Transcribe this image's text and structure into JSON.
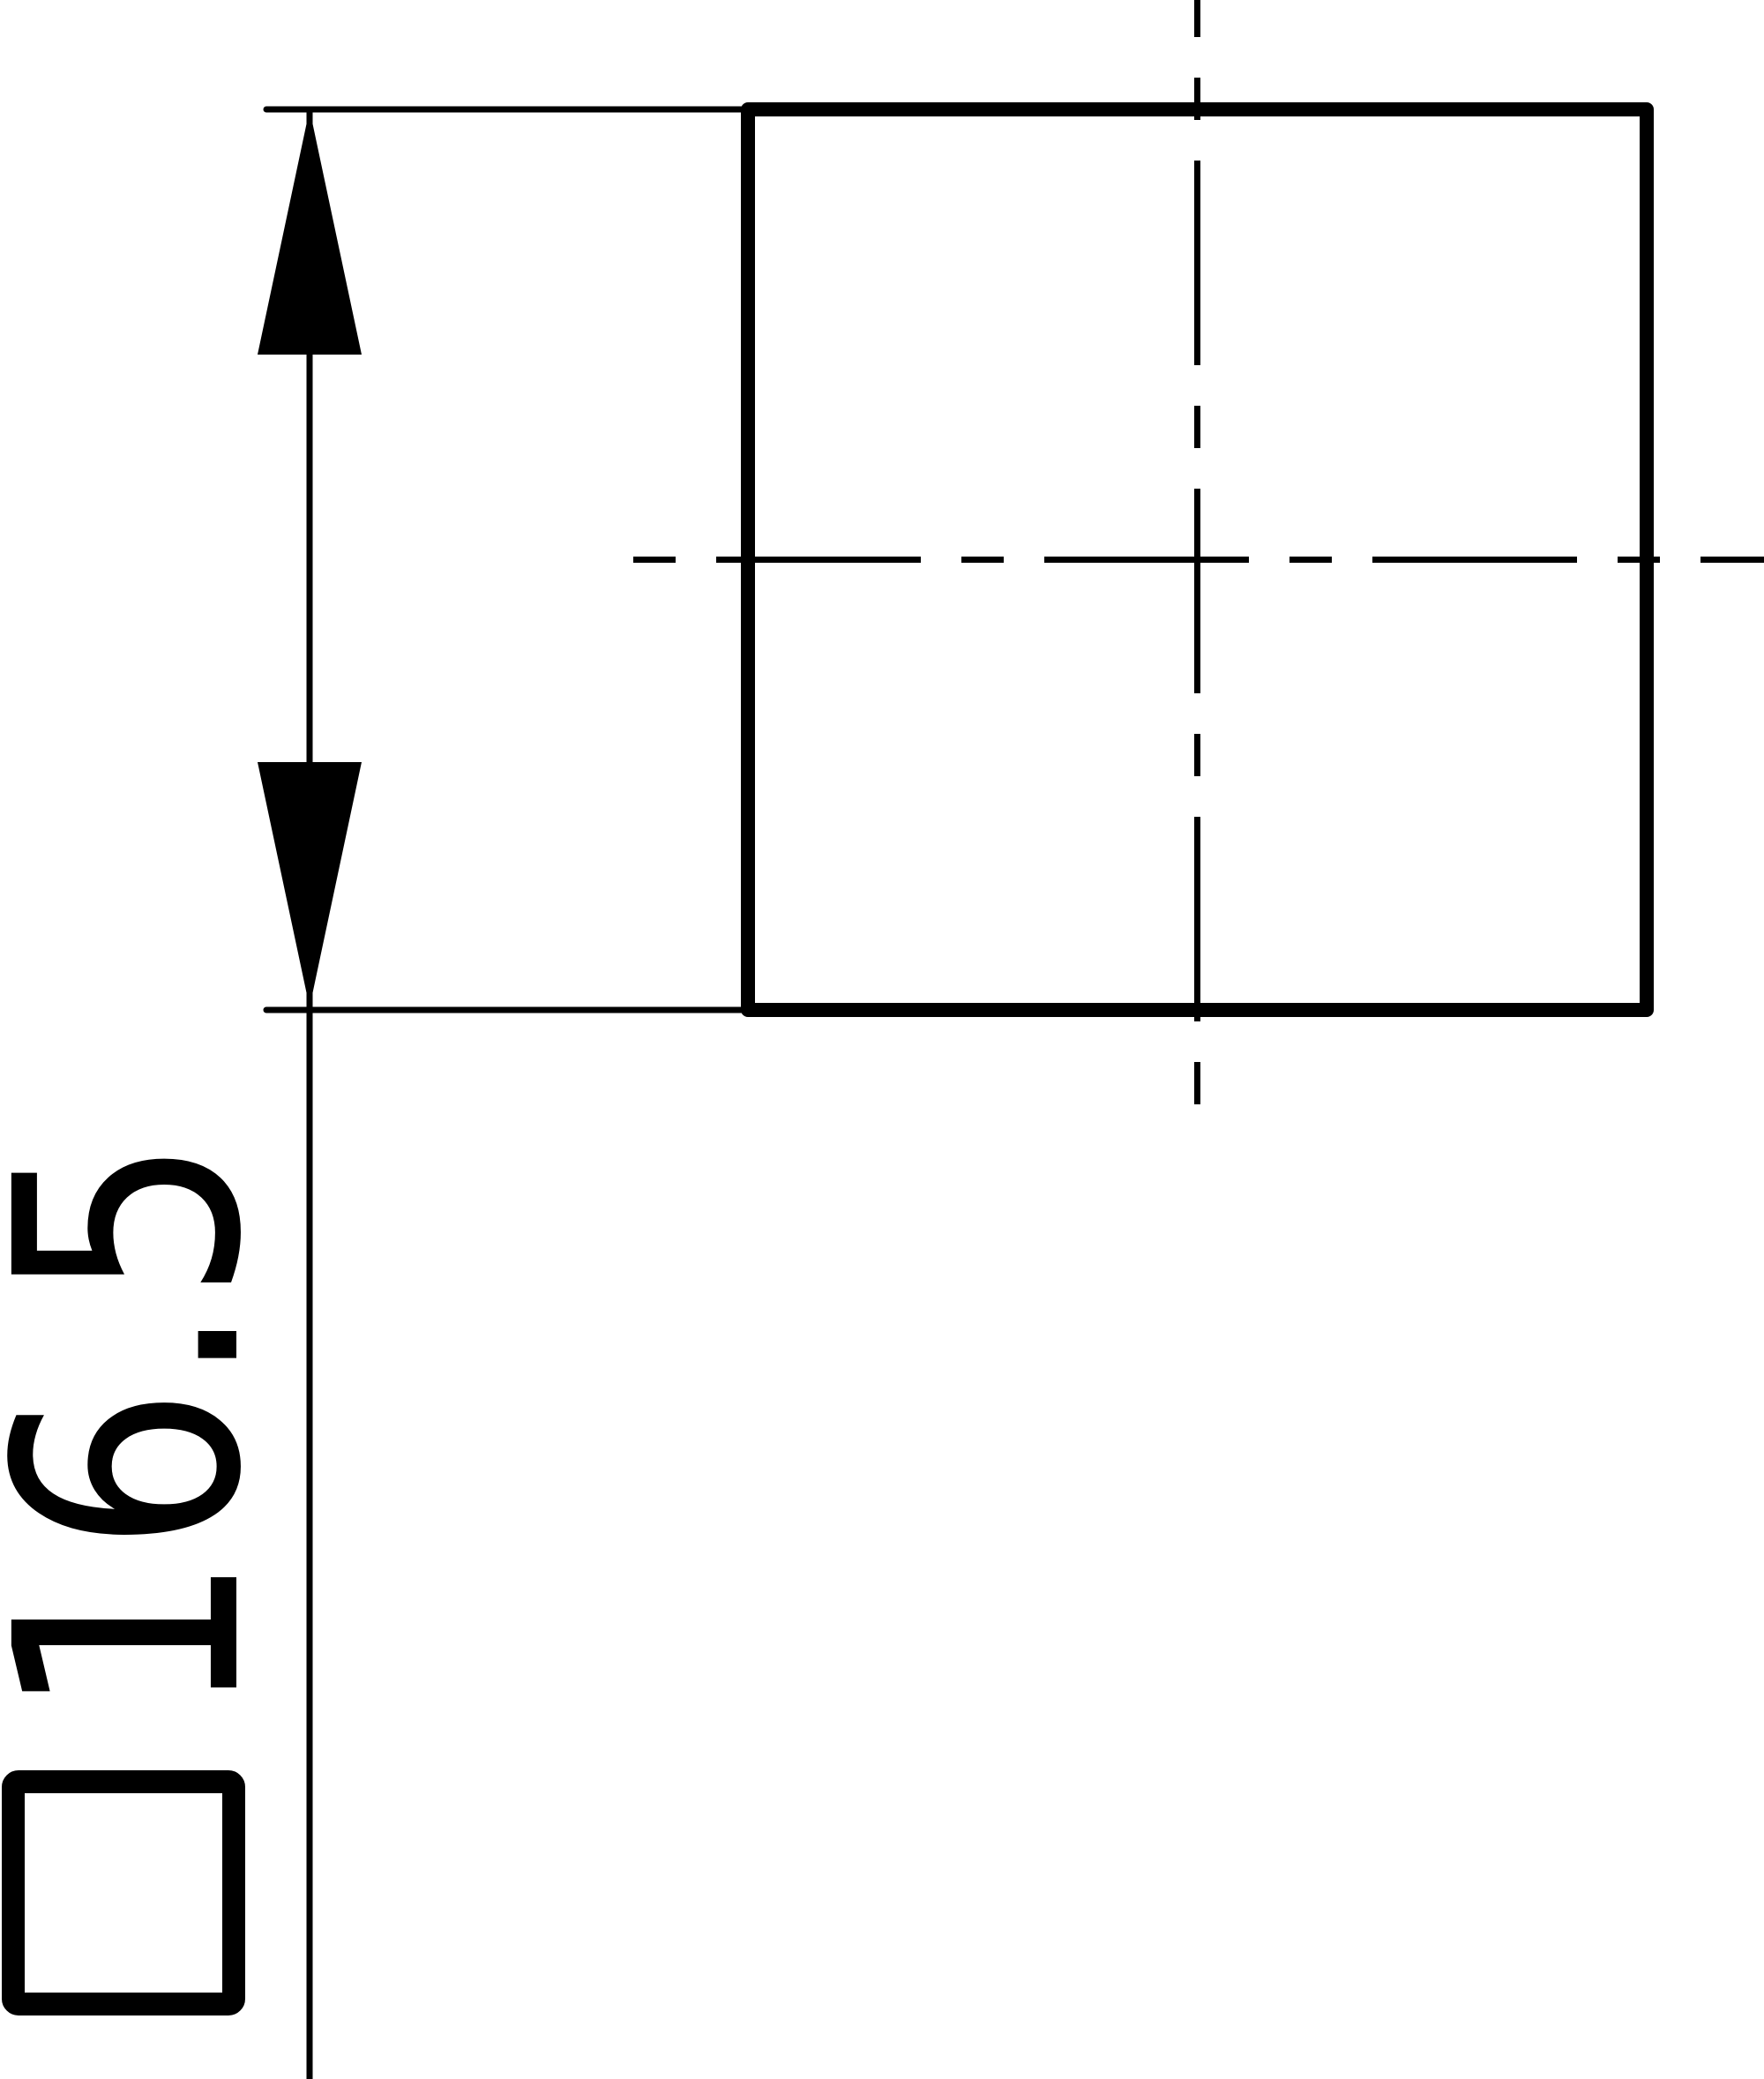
{
  "drawing": {
    "kind": "technical-drawing",
    "view": "square-profile-with-centerlines",
    "background_color": "#ffffff",
    "line_color": "#000000"
  },
  "dimension": {
    "symbol": "□",
    "value": "16.5",
    "full_label": "□16.5"
  }
}
